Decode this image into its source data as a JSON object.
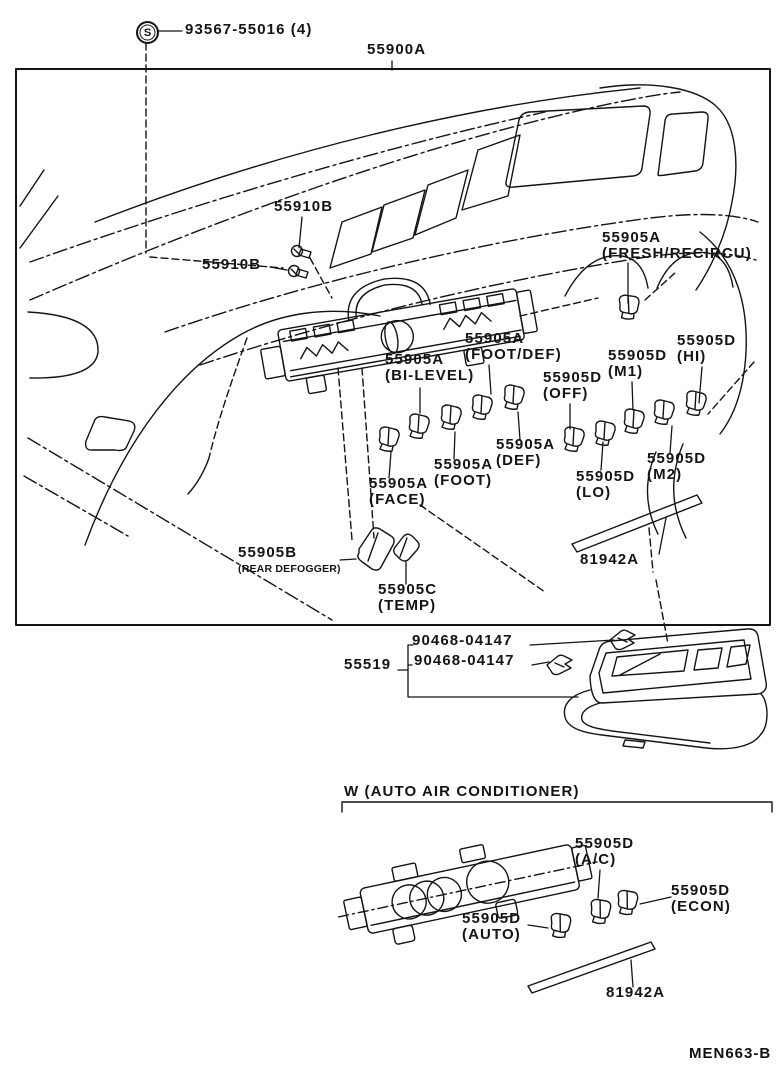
{
  "doc": {
    "code": "MEN663-B"
  },
  "header": {
    "screw_symbol": "S",
    "screw_part": "93567-55016 (4)",
    "assembly_part": "55900A"
  },
  "main_diagram": {
    "screw1": "55910B",
    "screw2": "55910B",
    "fresh": {
      "part": "55905A",
      "mode": "(FRESH/RECIRCU)"
    },
    "foot_def": {
      "part": "55905A",
      "mode": "(FOOT/DEF)"
    },
    "bi_level": {
      "part": "55905A",
      "mode": "(BI-LEVEL)"
    },
    "off": {
      "part": "55905D",
      "mode": "(OFF)"
    },
    "m1": {
      "part": "55905D",
      "mode": "(M1)"
    },
    "hi": {
      "part": "55905D",
      "mode": "(HI)"
    },
    "def": {
      "part": "55905A",
      "mode": "(DEF)"
    },
    "foot": {
      "part": "55905A",
      "mode": "(FOOT)"
    },
    "face": {
      "part": "55905A",
      "mode": "(FACE)"
    },
    "lo": {
      "part": "55905D",
      "mode": "(LO)"
    },
    "m2": {
      "part": "55905D",
      "mode": "(M2)"
    },
    "rear_defogger": {
      "part": "55905B",
      "mode": "(REAR DEFOGGER)"
    },
    "temp": {
      "part": "55905C",
      "mode": "(TEMP)"
    },
    "light_bar": "81942A"
  },
  "bezel_group": {
    "panel_part": "55519",
    "clip1": "90468-04147",
    "clip2": "90468-04147"
  },
  "auto_ac": {
    "section_title": "W (AUTO AIR CONDITIONER)",
    "ac": {
      "part": "55905D",
      "mode": "(A/C)"
    },
    "econ": {
      "part": "55905D",
      "mode": "(ECON)"
    },
    "auto": {
      "part": "55905D",
      "mode": "(AUTO)"
    },
    "light_bar": "81942A"
  }
}
